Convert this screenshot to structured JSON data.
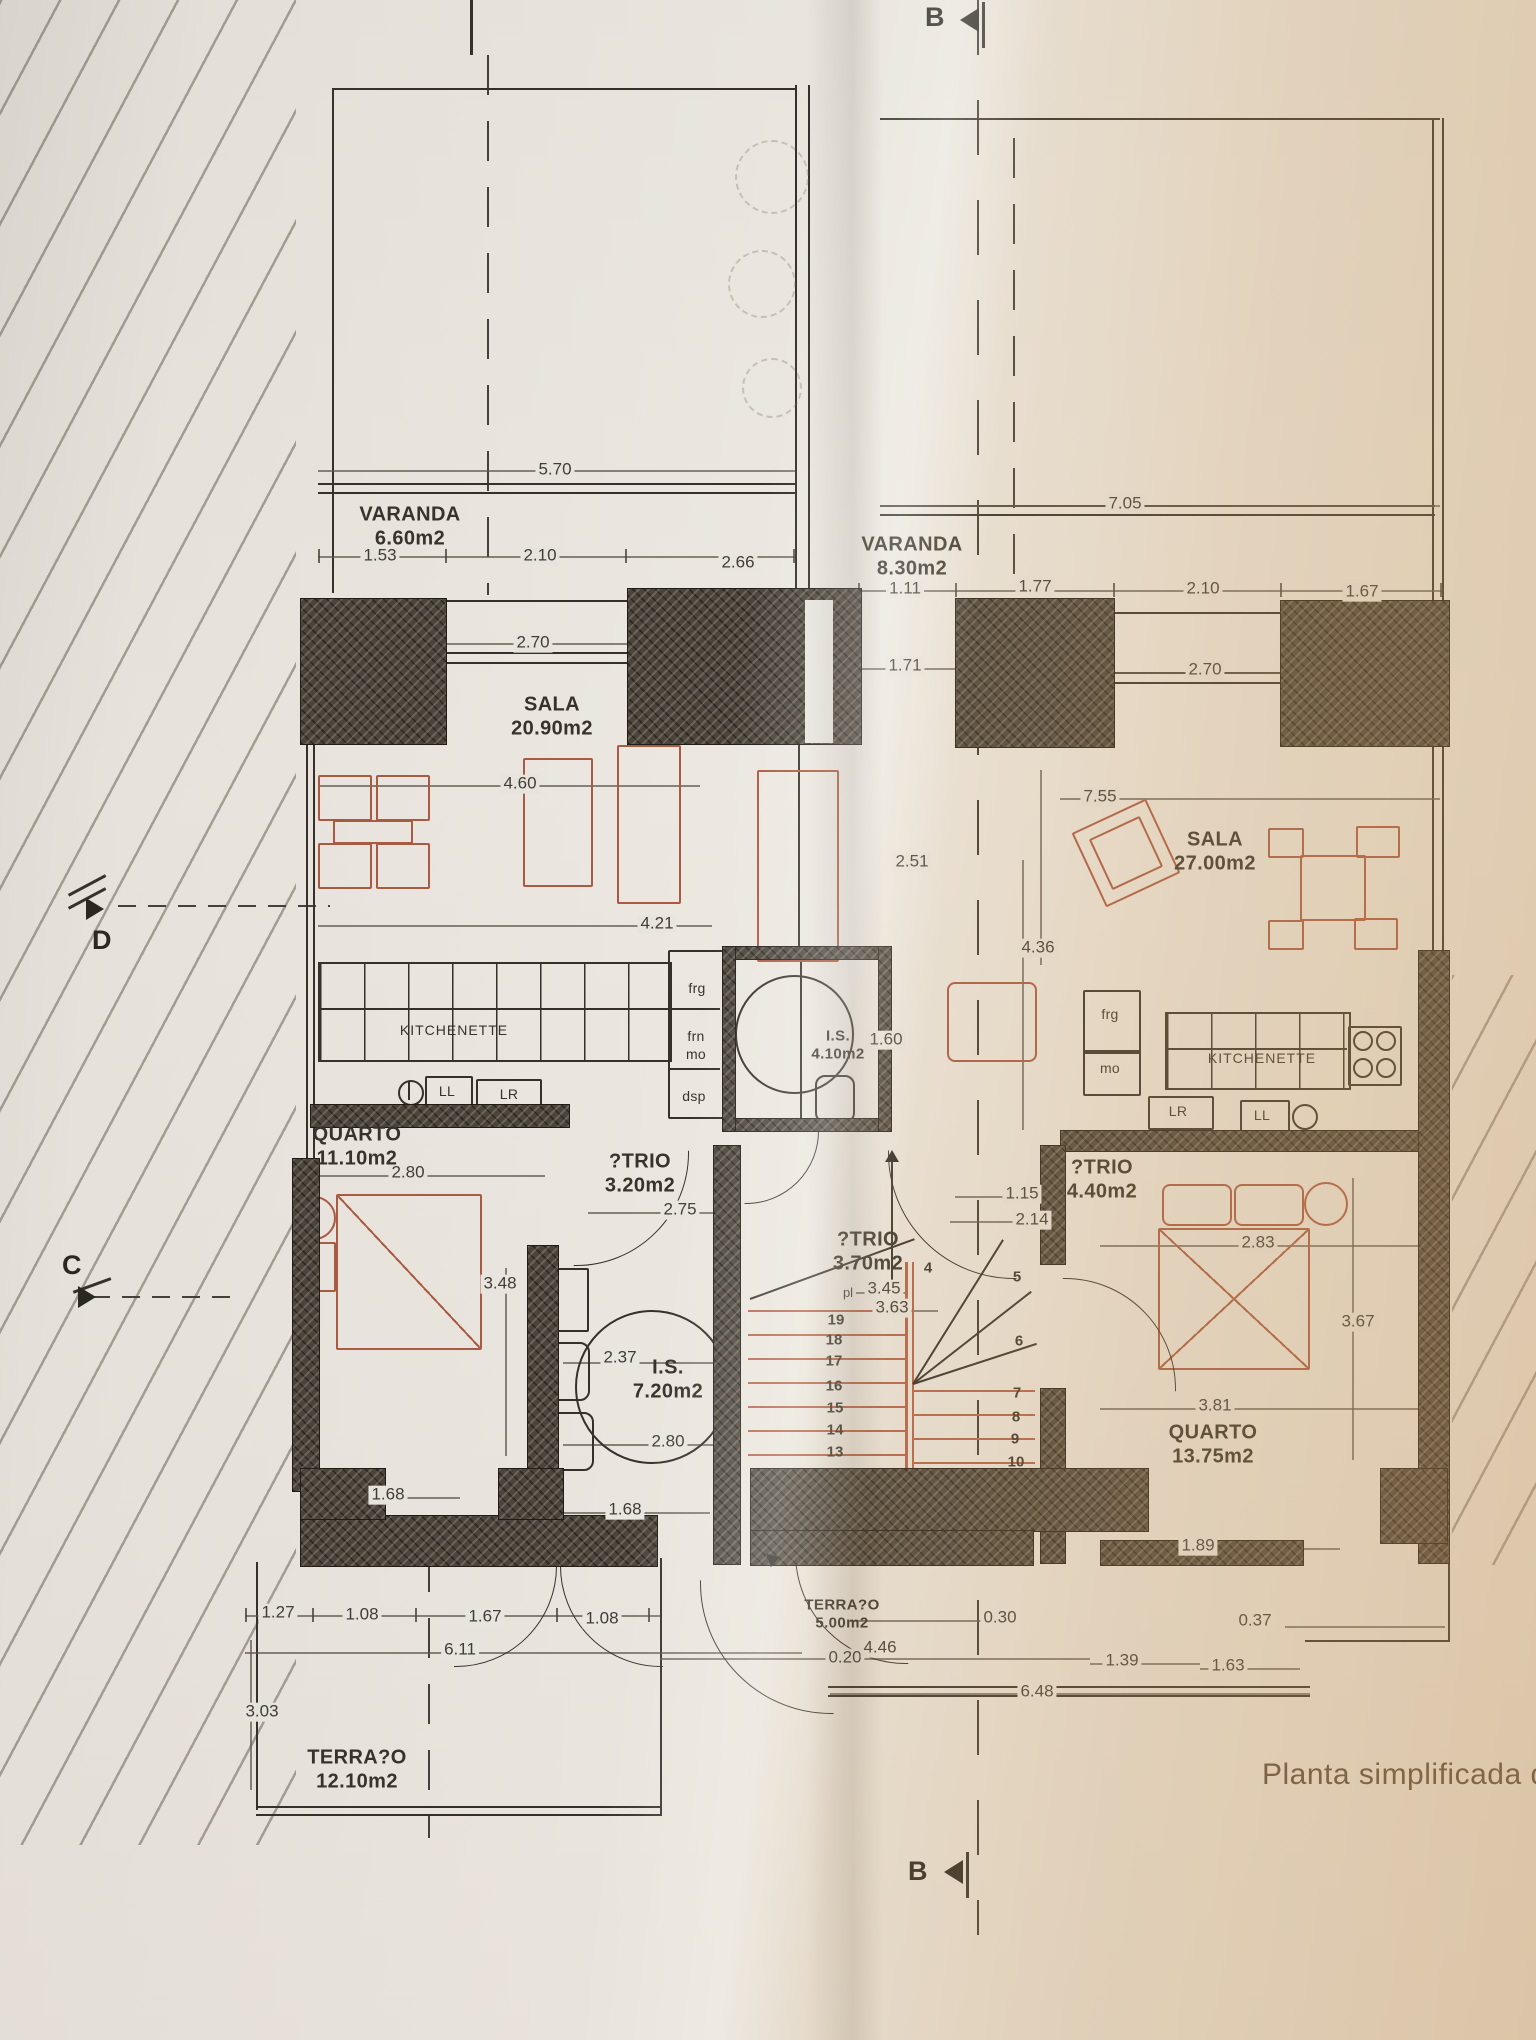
{
  "markers": {
    "b_top": "B",
    "b_bottom": "B",
    "c": "C",
    "d": "D"
  },
  "caption": "Planta simplificada d",
  "rooms": {
    "varanda_left": {
      "name": "VARANDA",
      "area": "6.60m2"
    },
    "varanda_right": {
      "name": "VARANDA",
      "area": "8.30m2"
    },
    "sala_left": {
      "name": "SALA",
      "area": "20.90m2"
    },
    "sala_right": {
      "name": "SALA",
      "area": "27.00m2"
    },
    "quarto_left": {
      "name": "QUARTO",
      "area": "11.10m2"
    },
    "quarto_right": {
      "name": "QUARTO",
      "area": "13.75m2"
    },
    "atrio_left": {
      "name": "?TRIO",
      "area": "3.20m2"
    },
    "atrio_mid": {
      "name": "?TRIO",
      "area": "3.70m2"
    },
    "atrio_right": {
      "name": "?TRIO",
      "area": "4.40m2"
    },
    "is_small": {
      "name": "I.S.",
      "area": "4.10m2"
    },
    "is_large": {
      "name": "I.S.",
      "area": "7.20m2"
    },
    "terraco_mid": {
      "name": "TERRA?O",
      "area": "5.00m2"
    },
    "terraco_left": {
      "name": "TERRA?O",
      "area": "12.10m2"
    }
  },
  "kitchen_left": {
    "title": "KITCHENETTE",
    "frg": "frg",
    "frn": "frn",
    "mo": "mo",
    "dsp": "dsp",
    "ll": "LL",
    "lr": "LR"
  },
  "kitchen_right": {
    "title": "KITCHENETTE",
    "frg": "frg",
    "mo": "mo",
    "ll": "LL",
    "lr": "LR"
  },
  "stairs": {
    "top": "4",
    "left": [
      "19",
      "18",
      "17",
      "16",
      "15",
      "14",
      "13"
    ],
    "right": [
      "5",
      "6",
      "7",
      "8",
      "9",
      "10"
    ]
  },
  "dims": {
    "d570": "5.70",
    "d153": "1.53",
    "d210a": "2.10",
    "d266": "2.66",
    "d270a": "2.70",
    "d460": "4.60",
    "d421": "4.21",
    "d705": "7.05",
    "d111": "1.11",
    "d177": "1.77",
    "d210b": "2.10",
    "d167a": "1.67",
    "d171": "1.71",
    "d270b": "2.70",
    "d755": "7.55",
    "d251": "2.51",
    "d436": "4.36",
    "d160": "1.60",
    "d280a": "2.80",
    "d275": "2.75",
    "d115": "1.15",
    "d214": "2.14",
    "d283": "2.83",
    "d348": "3.48",
    "d237": "2.37",
    "d345": "3.45",
    "d363": "3.63",
    "d367": "3.67",
    "d280b": "2.80",
    "d381": "3.81",
    "d189": "1.89",
    "d168a": "1.68",
    "d168b": "1.68",
    "d127": "1.27",
    "d108a": "1.08",
    "d167b": "1.67",
    "d108b": "1.08",
    "d611": "6.11",
    "d303": "3.03",
    "d020": "0.20",
    "d446": "4.46",
    "d030": "0.30",
    "d037": "0.37",
    "d139": "1.39",
    "d163": "1.63",
    "d648": "6.48",
    "pl": "pl"
  }
}
